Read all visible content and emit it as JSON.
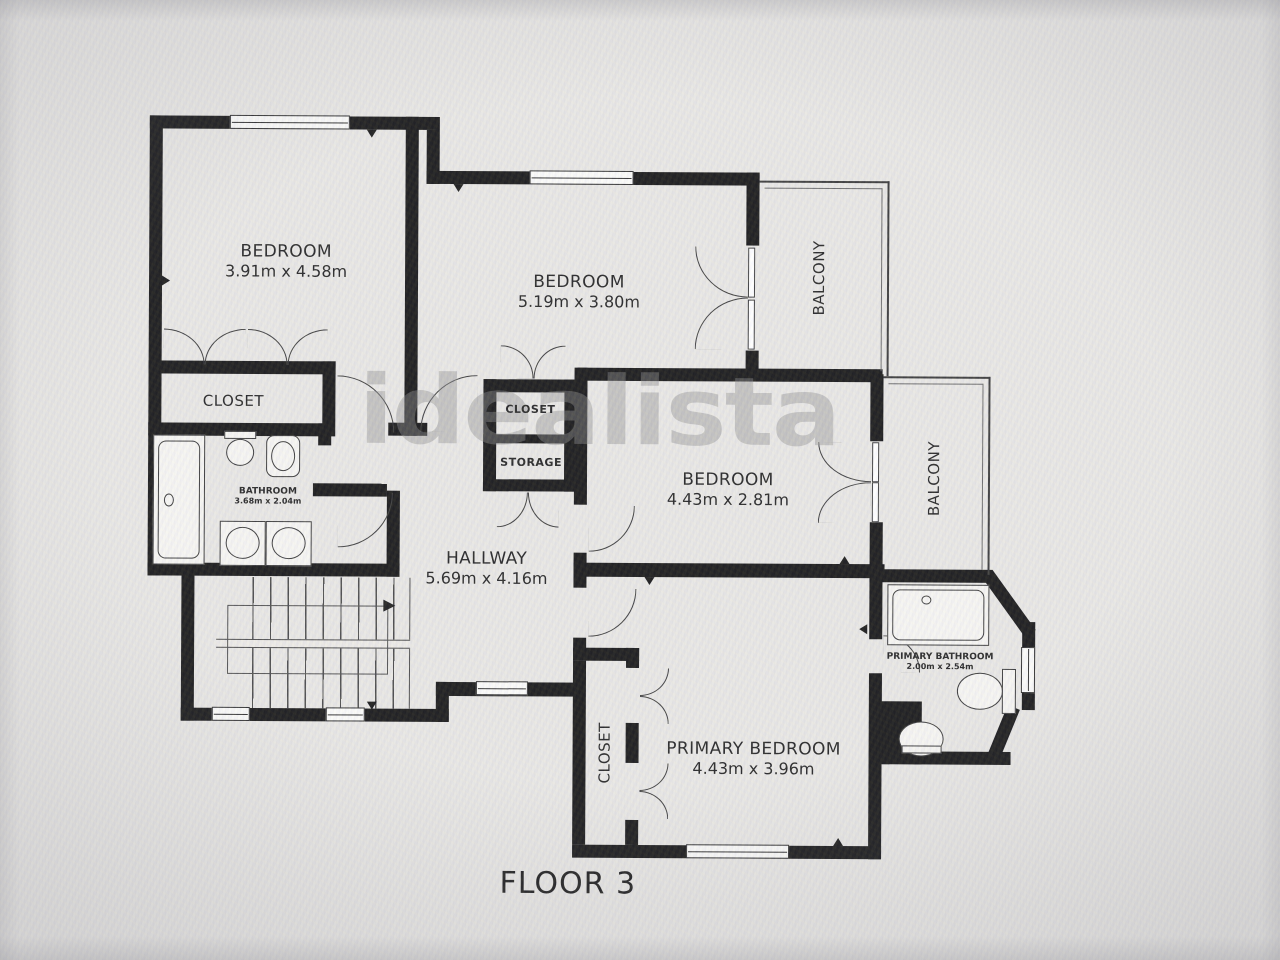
{
  "floor_plan": {
    "title": "FLOOR 3",
    "watermark": "idealista",
    "rooms": [
      {
        "id": "bedroom_top_left",
        "name": "BEDROOM",
        "dims": "3.91m x 4.58m"
      },
      {
        "id": "bedroom_top_middle",
        "name": "BEDROOM",
        "dims": "5.19m x 3.80m"
      },
      {
        "id": "bedroom_middle_right",
        "name": "BEDROOM",
        "dims": "4.43m x 2.81m"
      },
      {
        "id": "primary_bedroom",
        "name": "PRIMARY BEDROOM",
        "dims": "4.43m x 3.96m"
      },
      {
        "id": "hallway",
        "name": "HALLWAY",
        "dims": "5.69m x 4.16m"
      },
      {
        "id": "bathroom",
        "name": "BATHROOM",
        "dims": "3.68m x 2.04m"
      },
      {
        "id": "primary_bathroom",
        "name": "PRIMARY BATHROOM",
        "dims": "2.00m x 2.54m"
      },
      {
        "id": "closet_bedroom1",
        "name": "CLOSET"
      },
      {
        "id": "closet_hall",
        "name": "CLOSET"
      },
      {
        "id": "storage",
        "name": "STORAGE"
      },
      {
        "id": "closet_primary",
        "name": "CLOSET"
      },
      {
        "id": "balcony_top",
        "name": "BALCONY"
      },
      {
        "id": "balcony_right",
        "name": "BALCONY"
      }
    ],
    "colors": {
      "wall": "#181818",
      "paper": "#e8e7e4",
      "ink": "#242424",
      "watermark": "#8c8c8c"
    }
  }
}
